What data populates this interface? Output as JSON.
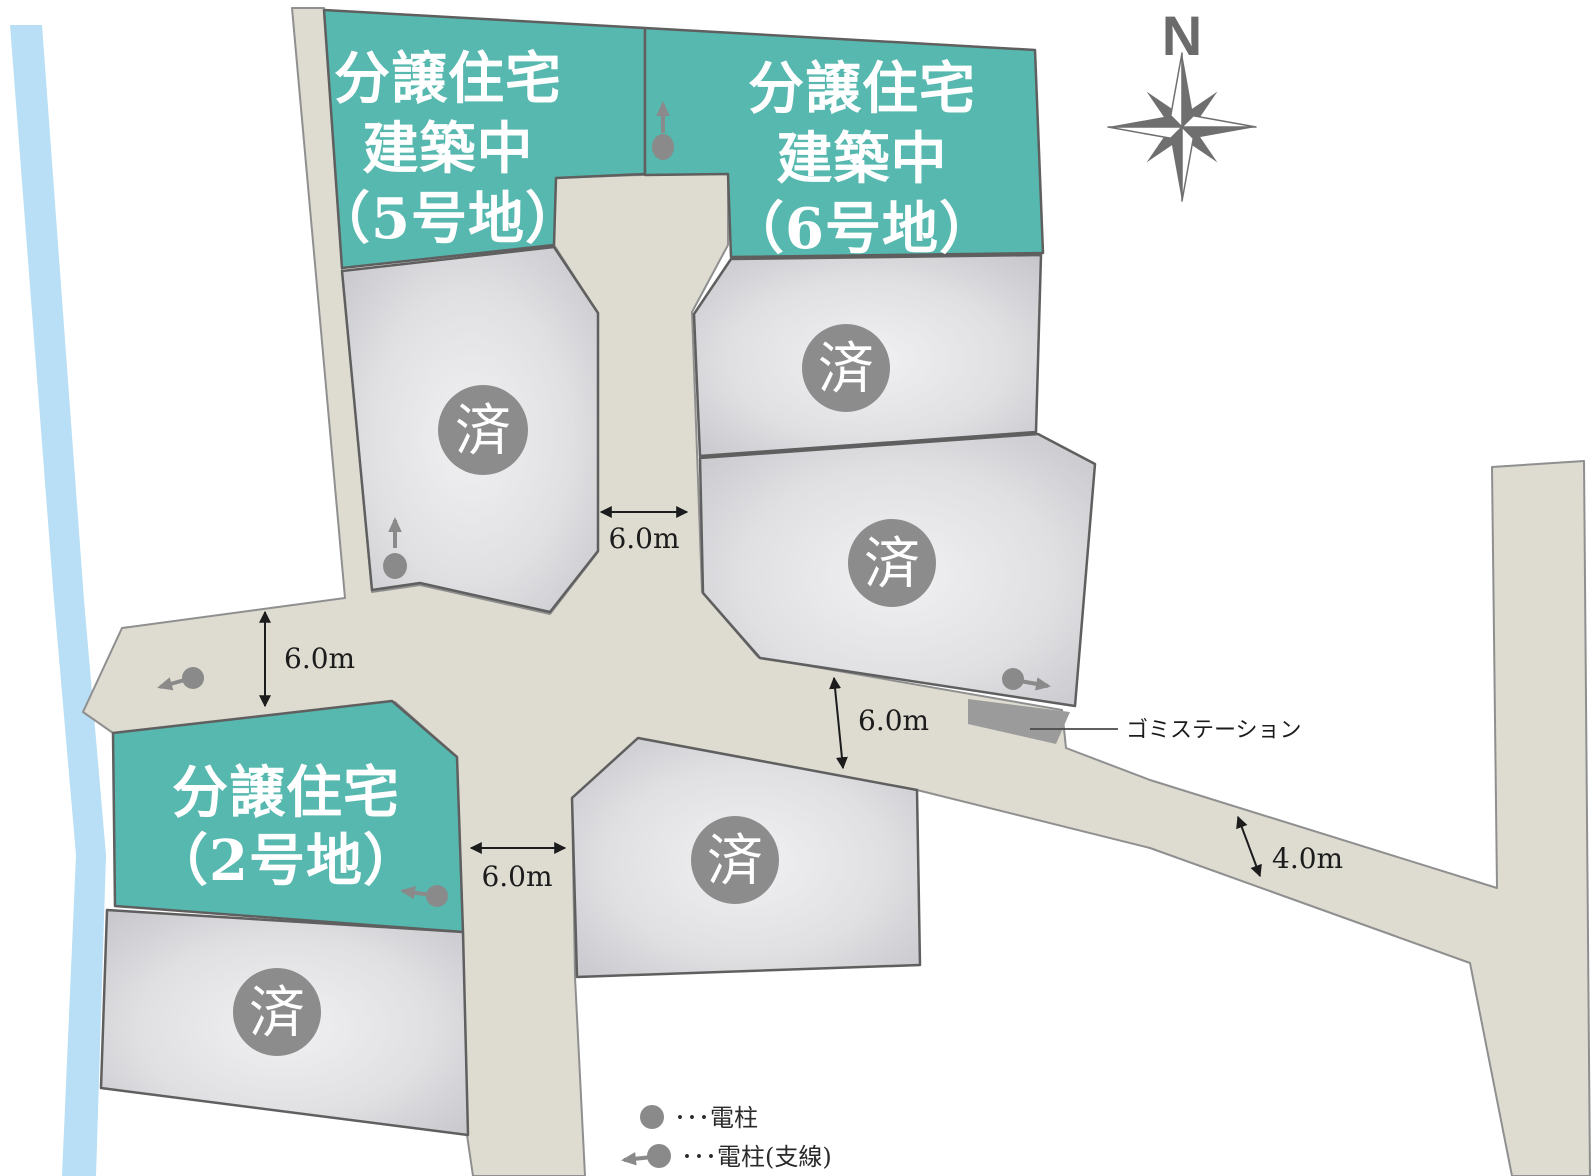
{
  "compass": {
    "label": "N"
  },
  "lots": {
    "for_sale": [
      {
        "id": "lot-5",
        "label_lines": [
          "分譲住宅",
          "建築中",
          "（5号地）"
        ]
      },
      {
        "id": "lot-6",
        "label_lines": [
          "分譲住宅",
          "建築中",
          "（6号地）"
        ]
      },
      {
        "id": "lot-2",
        "label_lines": [
          "分譲住宅",
          "（2号地）"
        ]
      }
    ],
    "sold_badge": "済",
    "sold_count": 5
  },
  "dimensions": [
    "6.0m",
    "6.0m",
    "6.0m",
    "6.0m",
    "4.0m"
  ],
  "garbage_station": {
    "label": "ゴミステーション"
  },
  "legend": {
    "items": [
      {
        "symbol": "utility-pole-icon",
        "label": "･･･電柱"
      },
      {
        "symbol": "utility-pole-guy-wire-icon",
        "label": "･･･電柱(支線)"
      }
    ]
  },
  "colors": {
    "for_sale_fill": "#56b8ae",
    "sold_lot_center": "#f1f1f3",
    "sold_lot_edge": "#c5c5ca",
    "road_fill": "#dedcd1",
    "road_stroke": "#8f8f8f",
    "lot_stroke": "#5f5f5f",
    "river_fill": "#b8dff5",
    "sold_badge_fill": "#8c8c8c",
    "pole_fill": "#8a8a8a",
    "compass_fill": "#6b6b6b",
    "garbage_patch_fill": "#9b9b9b"
  }
}
